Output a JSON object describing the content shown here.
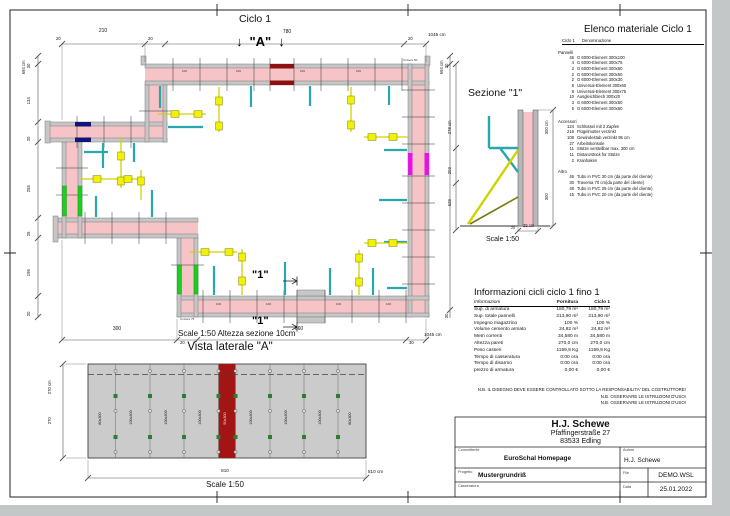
{
  "page": {
    "plan": {
      "title": "Ciclo 1",
      "arrow_down": "↓",
      "marker_a": "\"A\"",
      "marker_1": "\"1\"",
      "scale_note": "Scale 1:50   Altezza sezione 10cm",
      "panel_100": "100",
      "univers_75": "Univers 75",
      "univers_50": "Univers 50",
      "dims": {
        "top": [
          "20",
          "210",
          "20",
          "780",
          "20",
          "1045 cm"
        ],
        "left": [
          "694 cm",
          "30",
          "134",
          "20",
          "255",
          "25",
          "195",
          "20"
        ],
        "right": [
          "694 cm",
          "30",
          "278 cm",
          "203",
          "629",
          "30"
        ],
        "bottom": [
          "300",
          "20",
          "660",
          "30",
          "1045 cm"
        ]
      }
    },
    "sezione": {
      "title": "Sezione \"1\"",
      "scale": "Scale 1:50",
      "dim_300cm": "300 cm",
      "dim_300": "300",
      "dim_20": "20",
      "dim_25cm": "25 cm"
    },
    "vista": {
      "title": "Vista laterale \"A\"",
      "scale": "Scale 1:50",
      "dim_270cm": "270 cm",
      "dim_270": "270",
      "dim_810": "810",
      "dim_810cm": "810 cm",
      "panels": [
        "80x300",
        "100x300",
        "100x300",
        "100x300",
        "50x300",
        "100x300",
        "100x300",
        "100x300",
        "80x300"
      ]
    },
    "elenco": {
      "title": "Elenco materiale  Ciclo 1",
      "col_ciclo": "Ciclo 1",
      "col_denominazione": "Denominazione",
      "group_pannelli": "Pannelli",
      "group_accessori": "Accessori",
      "group_altro": "Altro",
      "pannelli": [
        {
          "qty": "46",
          "name": "G 6000-Element 300x100"
        },
        {
          "qty": "4",
          "name": "G 6000-Element 300x75"
        },
        {
          "qty": "2",
          "name": "G 6000-Element 300x60"
        },
        {
          "qty": "2",
          "name": "G 6000-Element 300x50"
        },
        {
          "qty": "2",
          "name": "G 6000-Element 300x30"
        },
        {
          "qty": "8",
          "name": "Universal-Element 300x60"
        },
        {
          "qty": "8",
          "name": "Universal-Element 300x75"
        },
        {
          "qty": "10",
          "name": "Ausgleichblech 300x20"
        },
        {
          "qty": "3",
          "name": "G 6000-Element 300x50"
        },
        {
          "qty": "5",
          "name": "G 6000-Element 300x60"
        }
      ],
      "accessori": [
        {
          "qty": "124",
          "name": "Schlüssel mit 2 Zapfen"
        },
        {
          "qty": "216",
          "name": "Flügelmutter verzinkt"
        },
        {
          "qty": "108",
          "name": "Gewindestab verzinkt 95 cm"
        },
        {
          "qty": "27",
          "name": "Arbeitskonsole"
        },
        {
          "qty": "11",
          "name": "Stütze verstellbar max. 300 cm"
        },
        {
          "qty": "11",
          "name": "Distanzstück für Stütze"
        },
        {
          "qty": "2",
          "name": "Kranhaken"
        }
      ],
      "altro": [
        {
          "qty": "46",
          "name": "Tubo in PVC 30 cm (da parte del cliente)"
        },
        {
          "qty": "30",
          "name": "Traversa 70 cm(da parte del cliente)"
        },
        {
          "qty": "48",
          "name": "Tubo in PVC 25 cm (da parte del cliente)"
        },
        {
          "qty": "15",
          "name": "Tubo in PVC 20 cm (da parte del cliente)"
        }
      ]
    },
    "info": {
      "title": "Informazioni cicli  ciclo 1 fino 1",
      "col_informazioni": "Informazioni",
      "col_fornitura": "Fornitura",
      "col_ciclo1": "Ciclo 1",
      "rows": [
        {
          "label": "Sup. di armatura",
          "fornitura": "180,79 m²",
          "ciclo1": "180,79 m²"
        },
        {
          "label": "Sup. totale pannelli",
          "fornitura": "213,90 m²",
          "ciclo1": "213,90 m²"
        },
        {
          "label": "Impegno magazzino",
          "fornitura": "100 %",
          "ciclo1": "100 %"
        },
        {
          "label": "Volume cemento armato",
          "fornitura": "24,82 m³",
          "ciclo1": "24,82 m³"
        },
        {
          "label": "Metri correnti",
          "fornitura": "34,580 m",
          "ciclo1": "34,580 m"
        },
        {
          "label": "Altezza pareti",
          "fornitura": "270,0 cm",
          "ciclo1": "270,0 cm"
        },
        {
          "label": "Peso casseri",
          "fornitura": "1159,9 Kg",
          "ciclo1": "1159,9 Kg"
        },
        {
          "label": "Tempo di casseratura",
          "fornitura": "0:00 ora",
          "ciclo1": "0:00 ora"
        },
        {
          "label": "Tempo di disarmo",
          "fornitura": "0:00 ora",
          "ciclo1": "0:00 ora"
        },
        {
          "label": "prezzo di armatura",
          "fornitura": "0,00 €",
          "ciclo1": "0,00 €"
        }
      ],
      "note1": "N.B. IL DISEGNO DEVE ESSERE CONTROLLATO SOTTO LA RESPONSABILITA' DEL COSTRUTTORE!",
      "note2": "N.B. OSSERVARE LE ISTRUZIONI D'USO!",
      "note3": "N.B. OSSERVARE LE ISTRUZIONI D'USO!"
    },
    "titleblock": {
      "company": "H.J. Schewe",
      "street": "Pfaffingerstraße 27",
      "city": "83533 Edling",
      "committente_label": "Committente",
      "committente": "EuroSchal Homepage",
      "autore_label": "Autore",
      "autore": "H.J. Schewe",
      "progetto_label": "Progetto",
      "progetto": "Mustergrundriß",
      "file_label": "File",
      "file": "DEMO.WSL",
      "casseratura_label": "Casseratura",
      "data_label": "Data",
      "data": "25.01.2022"
    }
  }
}
